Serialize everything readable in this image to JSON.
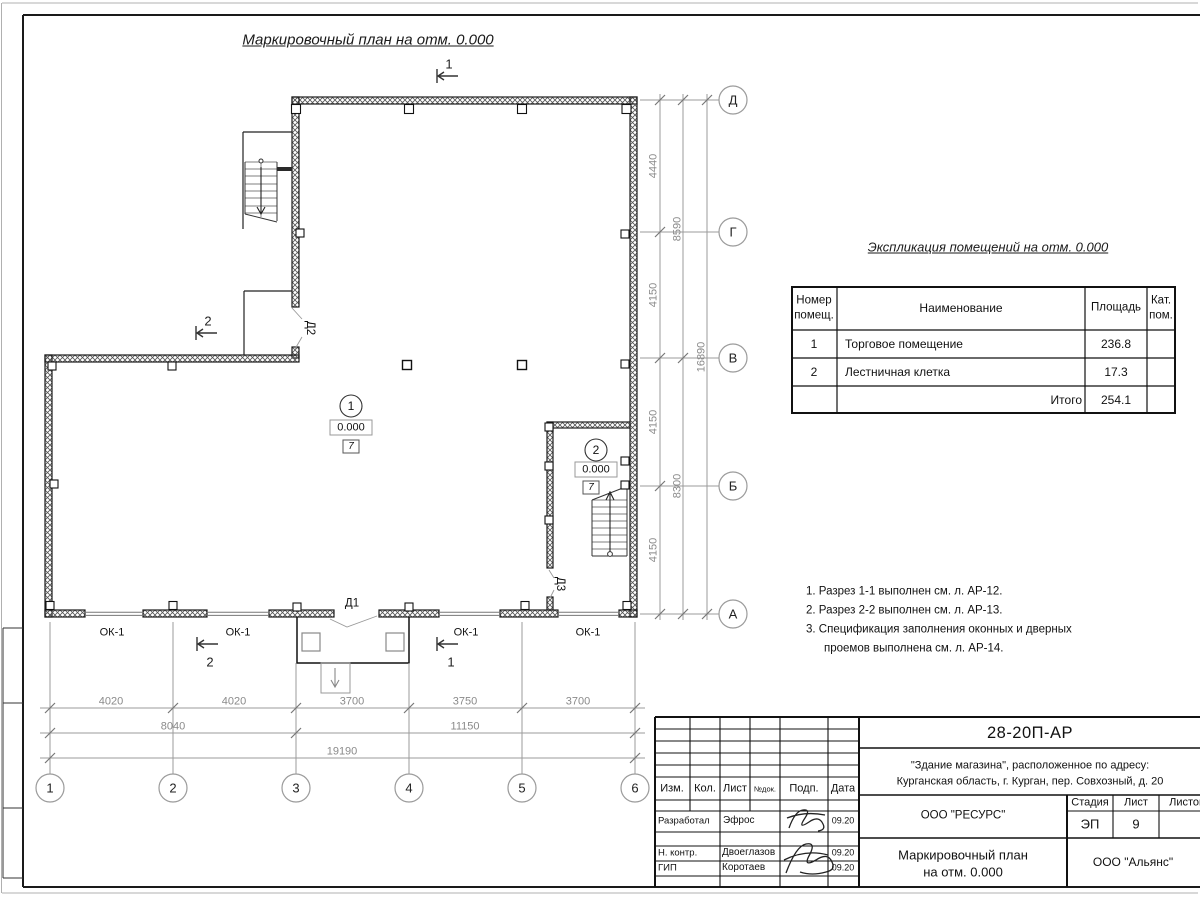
{
  "titles": {
    "plan": "Маркировочный план на отм. 0.000",
    "spec": "Экспликация помещений на отм. 0.000"
  },
  "axes": {
    "horizontal": [
      "1",
      "2",
      "3",
      "4",
      "5",
      "6"
    ],
    "vertical": [
      "Д",
      "Г",
      "В",
      "Б",
      "А"
    ]
  },
  "dims": {
    "b1": [
      "4020",
      "4020",
      "3700",
      "3750",
      "3700"
    ],
    "b2": [
      "8040",
      "11150"
    ],
    "b3": "19190",
    "r1": [
      "4440",
      "4150",
      "4150",
      "4150"
    ],
    "r2": [
      "8590",
      "8300"
    ],
    "r3": "16890"
  },
  "plan": {
    "rooms": [
      {
        "number": "1",
        "elevation": "0.000",
        "floor": "7"
      },
      {
        "number": "2",
        "elevation": "0.000",
        "floor": "7"
      }
    ],
    "doors": [
      "Д1",
      "Д2",
      "Д3"
    ],
    "window": "ОК-1",
    "sections": [
      "1",
      "2"
    ]
  },
  "spec": {
    "col_num1": "Номер",
    "col_num2": "помещ.",
    "col_name": "Наименование",
    "col_area": "Площадь",
    "col_cat1": "Кат.",
    "col_cat2": "пом.",
    "rows": [
      {
        "num": "1",
        "name": "Торговое помещение",
        "area": "236.8"
      },
      {
        "num": "2",
        "name": "Лестничная клетка",
        "area": "17.3"
      }
    ],
    "total_label": "Итого",
    "total": "254.1"
  },
  "notes": [
    "1. Разрез 1-1 выполнен см. л. АР-12.",
    "2. Разрез 2-2 выполнен см. л. АР-13.",
    "3. Спецификация заполнения оконных и дверных",
    "проемов выполнена см. л. АР-14."
  ],
  "tb": {
    "doc": "28-20П-АР",
    "proj1": "\"Здание магазина\", расположенное по адресу:",
    "proj2": "Курганская область, г. Курган, пер. Совхозный, д. 20",
    "h_izm": "Изм.",
    "h_kol": "Кол.",
    "h_list": "Лист",
    "h_ndok": "№док.",
    "h_podp": "Подп.",
    "h_data": "Дата",
    "r1_role": "Разработал",
    "r1_name": "Эфрос",
    "r1_date": "09.20",
    "r2_role": "Н. контр.",
    "r2_name": "Двоеглазов",
    "r2_date": "09.20",
    "r3_role": "ГИП",
    "r3_name": "Коротаев",
    "r3_date": "09.20",
    "org1": "ООО \"РЕСУРС\"",
    "stage_h": "Стадия",
    "list_h": "Лист",
    "listov_h": "Листов",
    "stage": "ЭП",
    "list": "9",
    "name1": "Маркировочный план",
    "name2": "на отм. 0.000",
    "org2": "ООО \"Альянс\""
  }
}
